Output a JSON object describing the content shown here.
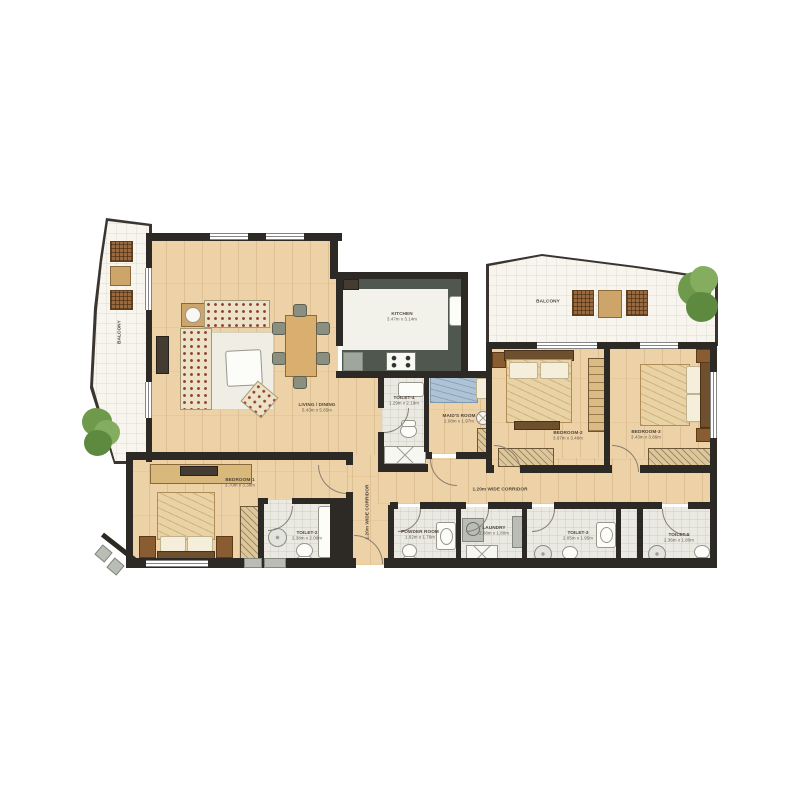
{
  "rooms": {
    "balcony_left": {
      "name": "BALCONY"
    },
    "balcony_right": {
      "name": "BALCONY"
    },
    "living": {
      "name": "LIVING / DINING",
      "dims": "5.43m x 5.65m"
    },
    "kitchen": {
      "name": "KITCHEN",
      "dims": "3.47m x 3.14m"
    },
    "toilet4": {
      "name": "TOILET-4",
      "dims": "1.29m x 2.19m"
    },
    "maids_room": {
      "name": "MAID'S ROOM",
      "dims": "2.08m x 1.97m"
    },
    "bedroom1": {
      "name": "BEDROOM-1",
      "dims": "3.70m x 3.38m"
    },
    "bedroom2": {
      "name": "BEDROOM-2",
      "dims": "3.67m x 3.48m"
    },
    "bedroom3": {
      "name": "BEDROOM-3",
      "dims": "3.43m x 3.86m"
    },
    "toilet2": {
      "name": "TOILET-2",
      "dims": "2.38m x 2.08m"
    },
    "powder_room": {
      "name": "POWDER ROOM",
      "dims": "1.62m x 1.76m"
    },
    "laundry": {
      "name": "LAUNDRY",
      "dims": "2.08m x 1.80m"
    },
    "toilet3": {
      "name": "TOILET-3",
      "dims": "2.05m x 1.95m"
    },
    "toilet5": {
      "name": "TOILET-5",
      "dims": "2.36m x 1.80m"
    },
    "corridor_v": {
      "name": "1.20m WIDE CORRIDOR"
    },
    "corridor_h": {
      "name": "1.20m WIDE CORRIDOR"
    }
  },
  "colors": {
    "wall": "#2d2a25",
    "wood_floor": "#ecd2a6",
    "balcony_tile": "#f7f5ee",
    "bath_tile": "#eaeae2",
    "kitchen_counter": "#50574e",
    "greenery": "#6f9a4c",
    "cushion_accent": "#96402f",
    "maid_bed": "#aec4d6",
    "label_text": "#4f463c"
  }
}
